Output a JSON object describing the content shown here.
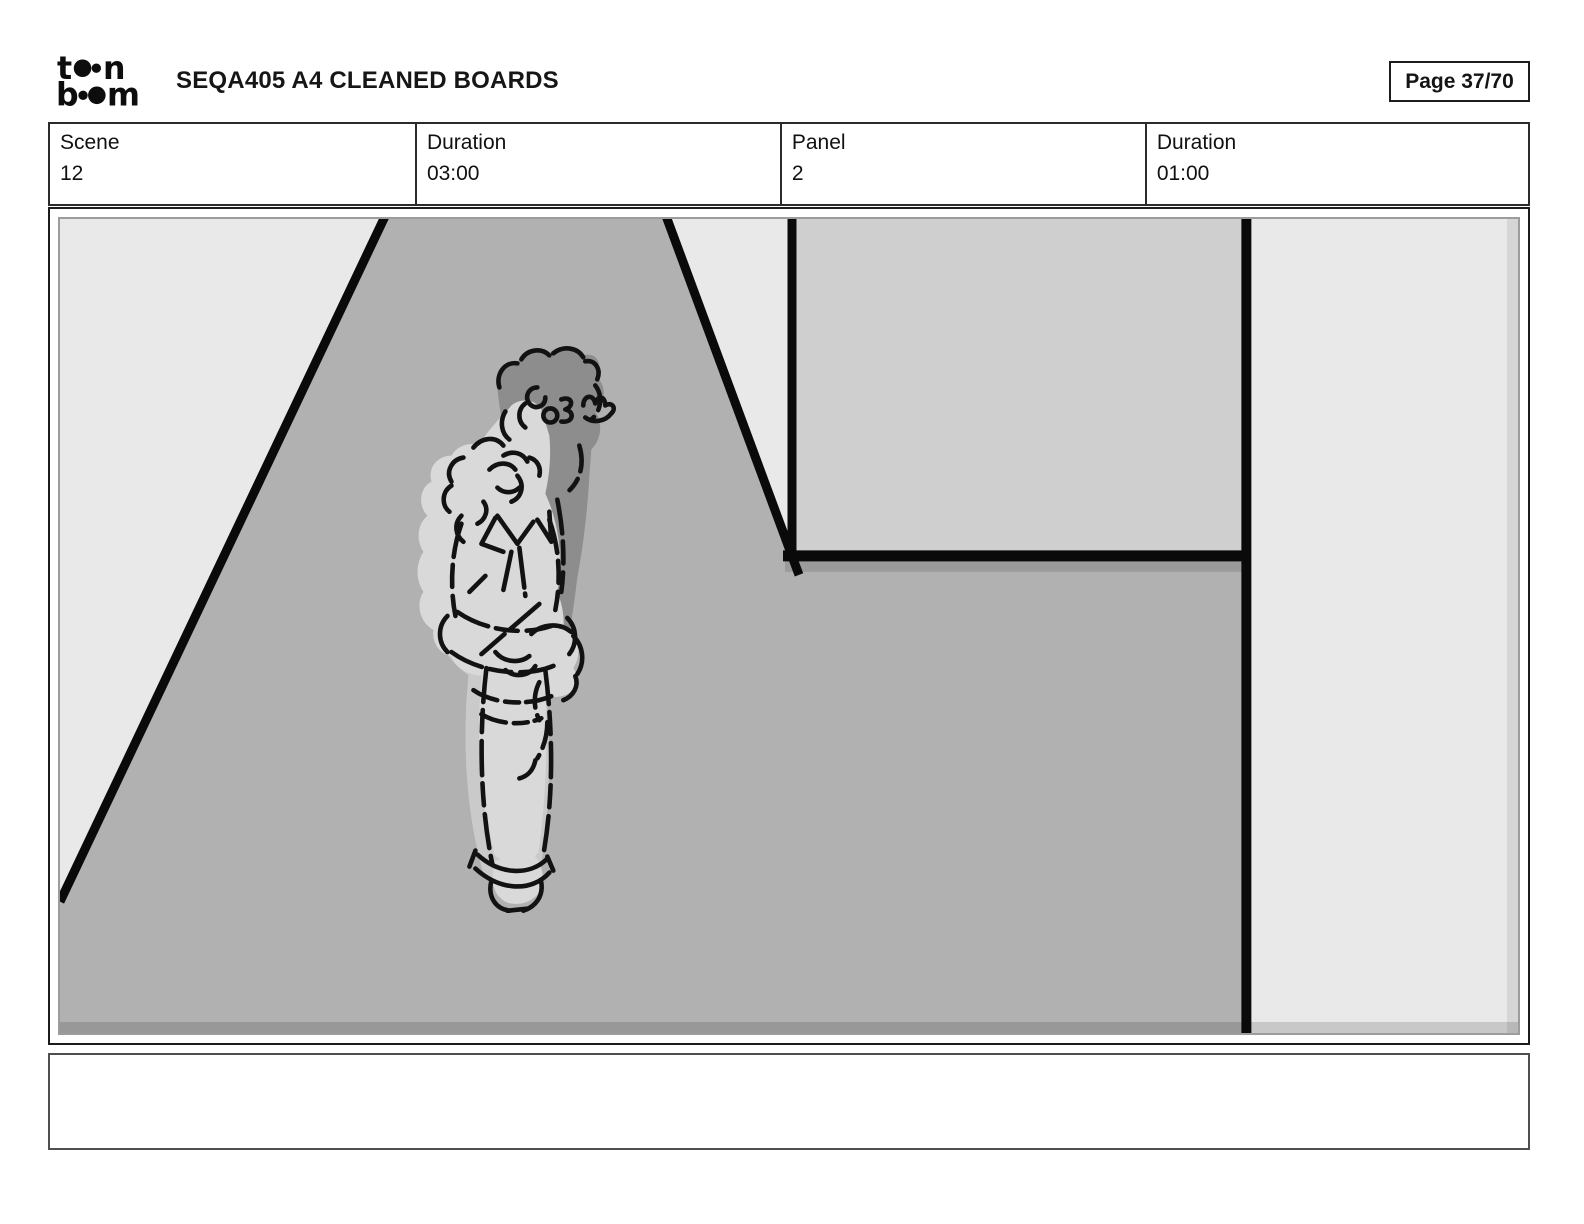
{
  "header": {
    "logo": {
      "letter_t": "t",
      "letter_n": "n",
      "letter_b": "b",
      "letter_m": "m"
    },
    "title": "SEQA405 A4 CLEANED BOARDS",
    "page_label": "Page 37/70"
  },
  "info_table": {
    "cells": [
      {
        "label": "Scene",
        "value": "12"
      },
      {
        "label": "Duration",
        "value": "03:00"
      },
      {
        "label": "Panel",
        "value": "2"
      },
      {
        "label": "Duration",
        "value": "01:00"
      }
    ]
  },
  "panel": {
    "caption": ""
  },
  "colors": {
    "artwork_bg": "#e9e9e9",
    "road": "#b1b1b1",
    "wall_rect": "#cfcfcf",
    "shadow_dark": "#8d8d8d",
    "figure_light": "#d9d9d9",
    "figure_halo": "#cacaca",
    "ink": "#121212",
    "thick_line": "#0a0a0a",
    "logo_ink": "#0d0d0d"
  }
}
